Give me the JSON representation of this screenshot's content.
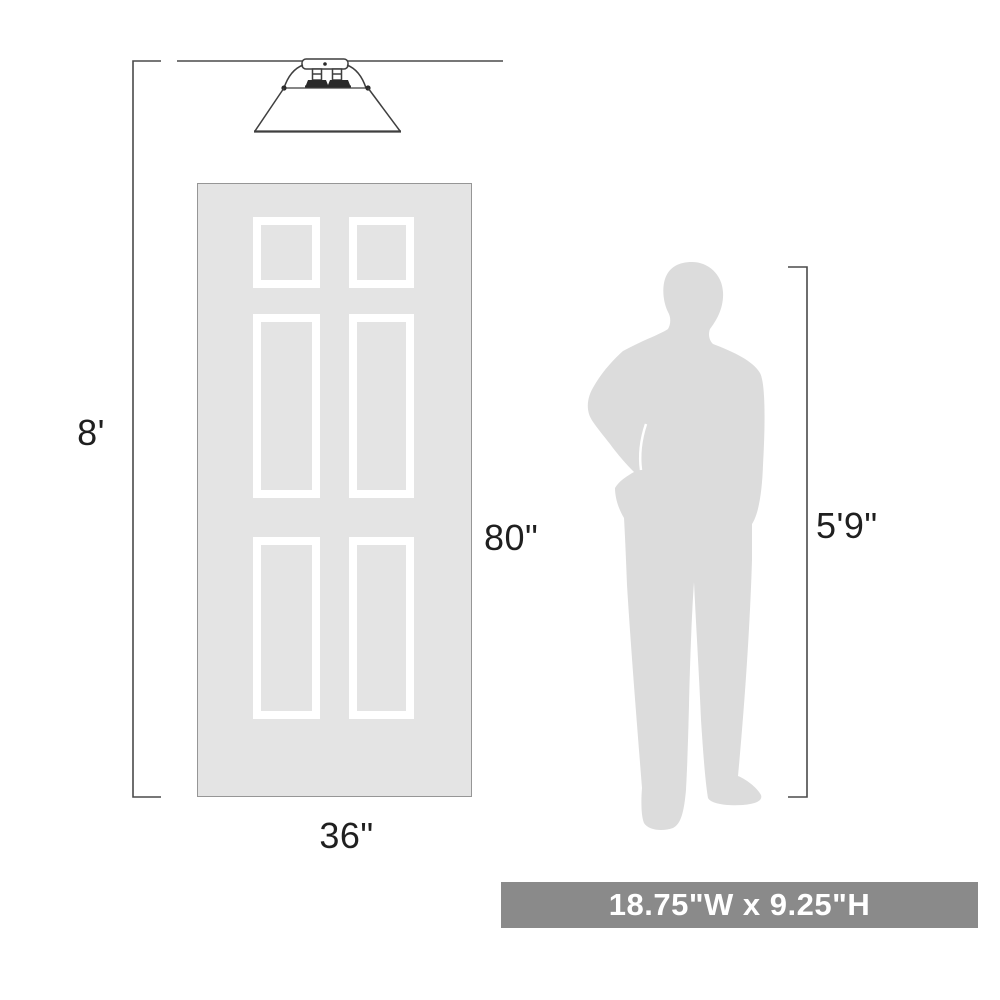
{
  "diagram": {
    "labels": {
      "ceiling_height": "8'",
      "door_height": "80\"",
      "door_width": "36\"",
      "person_height": "5'9\""
    },
    "banner": {
      "text": "18.75\"W x 9.25\"H"
    },
    "shapes": {
      "fixture": "flush-mount-cone-light",
      "door": "six-panel-door",
      "person": "standing-man-silhouette"
    },
    "colors": {
      "line": "#4a4a4a",
      "fixture_line": "#3f3f3f",
      "door_fill": "#e4e4e4",
      "door_border": "#969696",
      "panel_frame": "#ffffff",
      "person_fill": "#dcdcdc",
      "banner_bg": "#8a8a8a",
      "banner_text": "#ffffff",
      "label_text": "#1f1f1f"
    }
  }
}
